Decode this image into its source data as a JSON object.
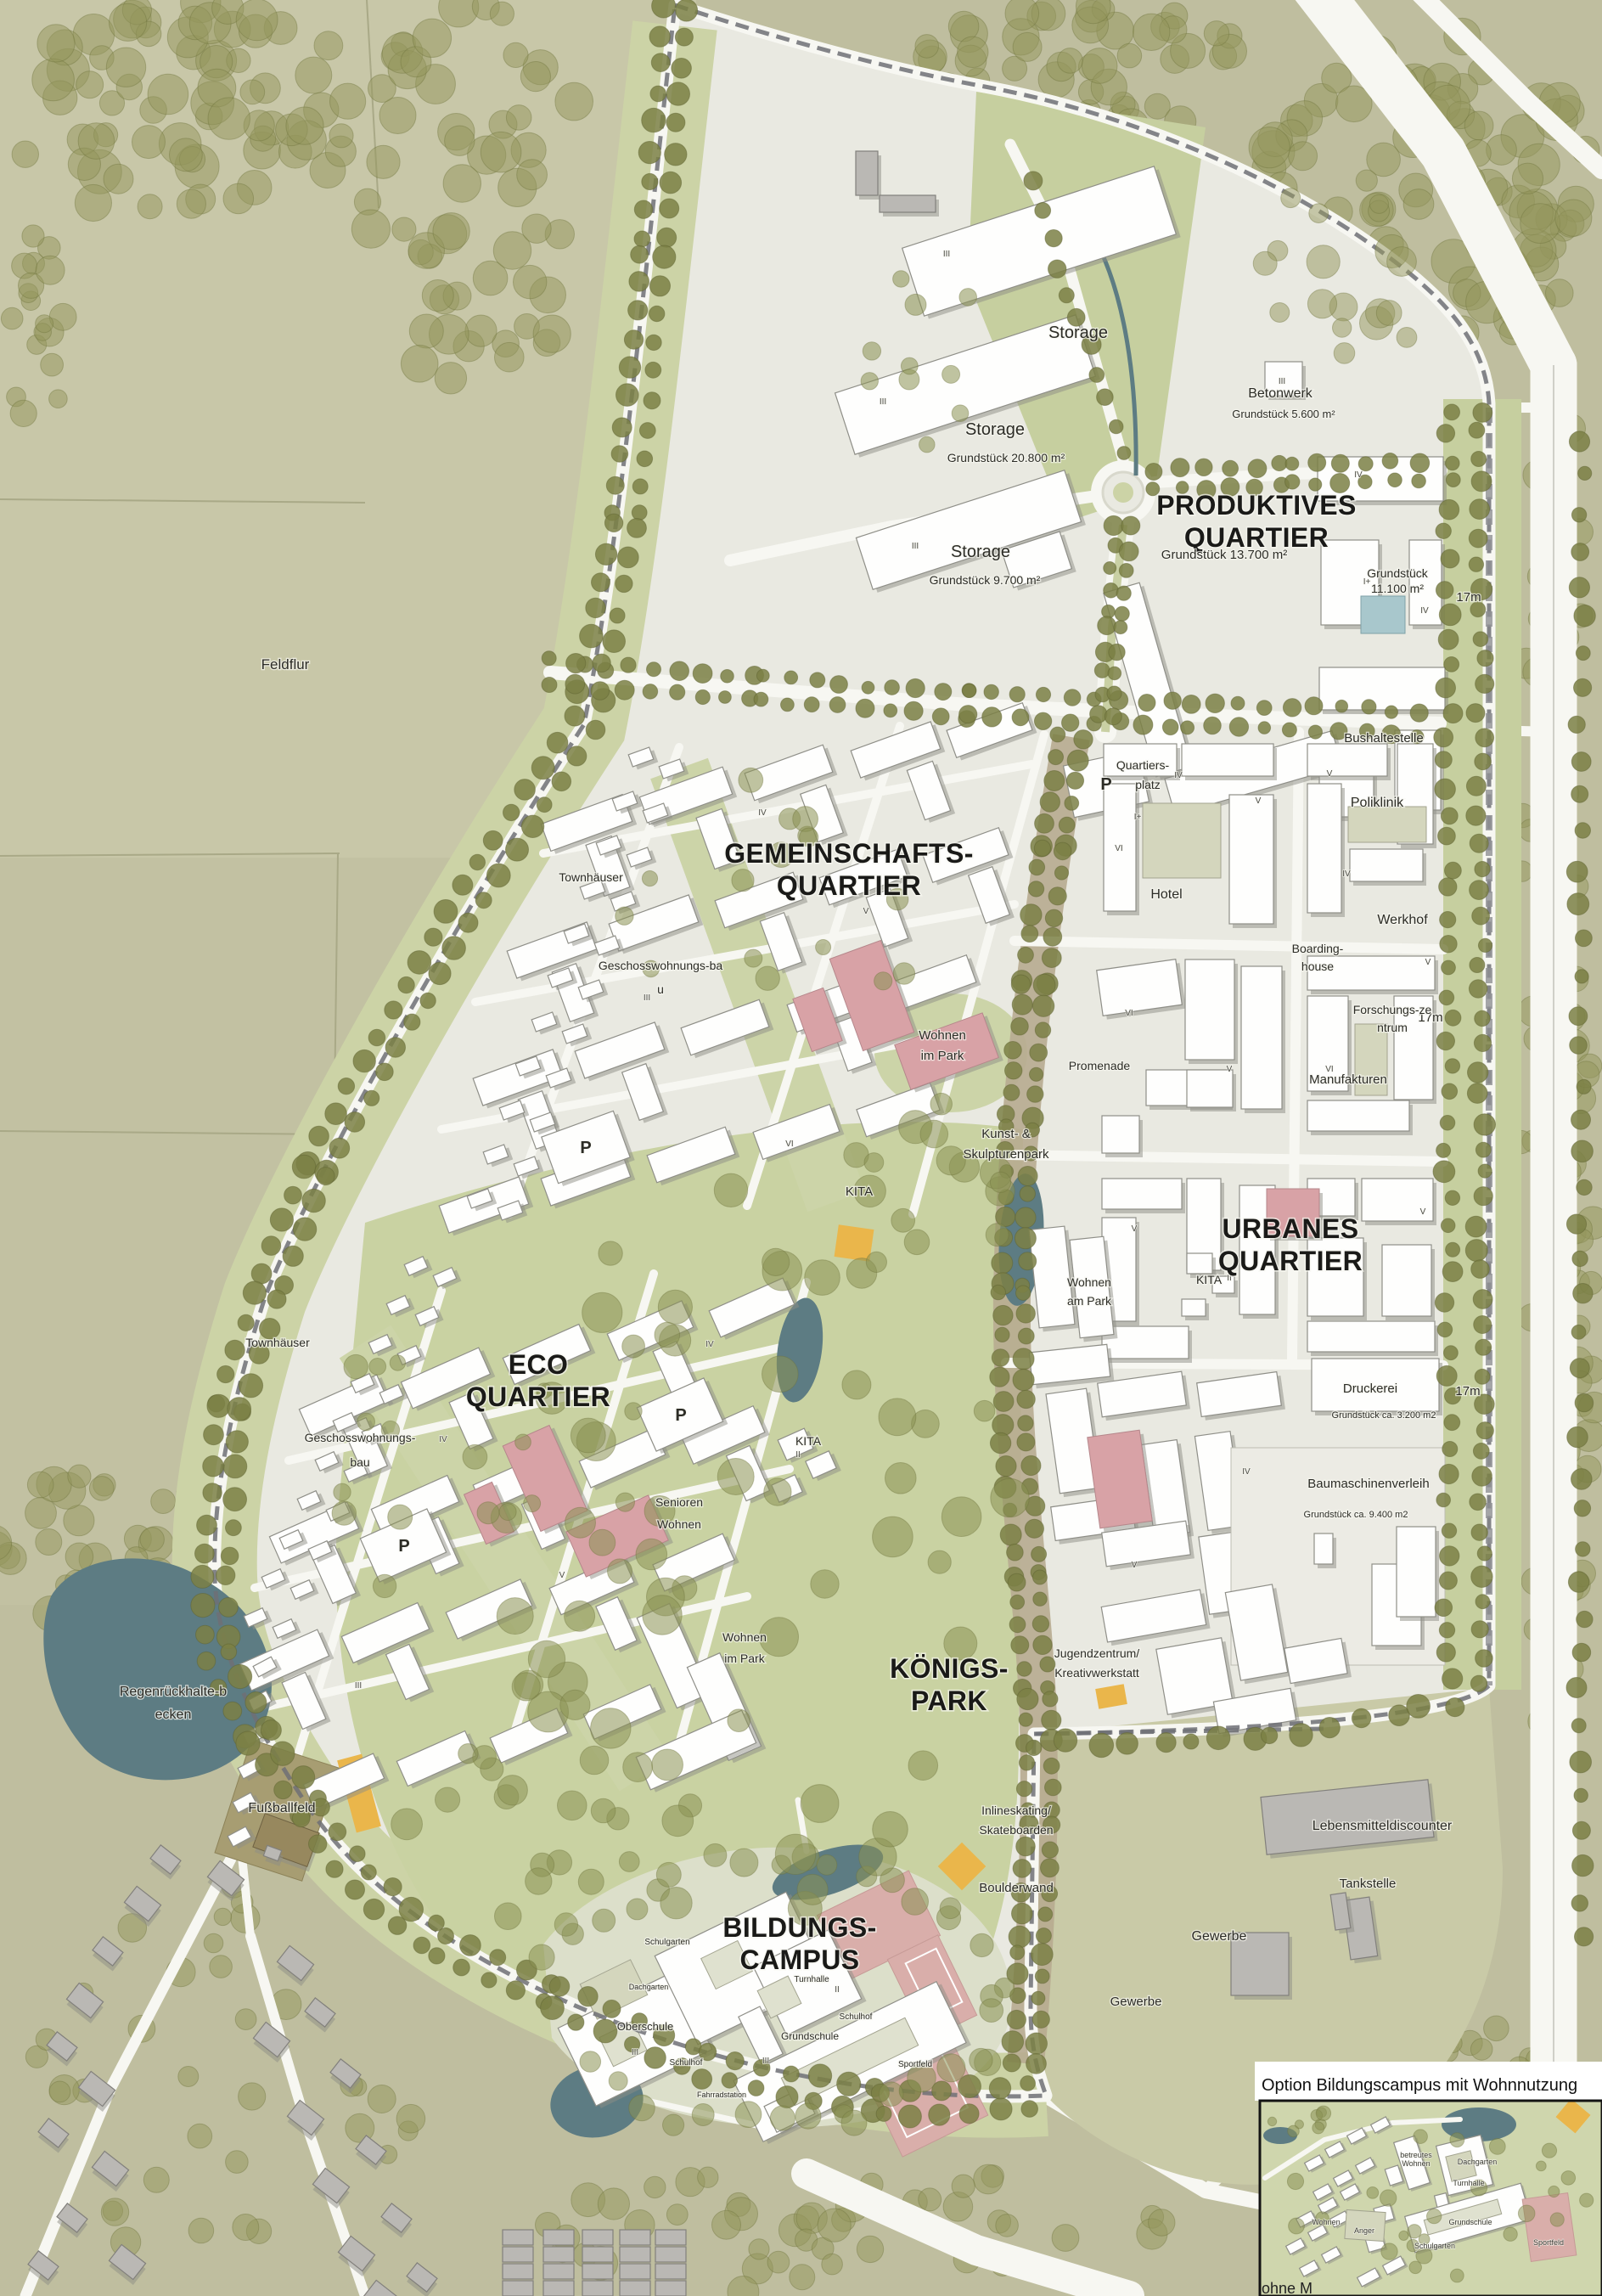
{
  "palette": {
    "field": "#bfbe9f",
    "field_light": "#c8c7a8",
    "forest_tree": "#94965c",
    "street_tree": "#7b8045",
    "site_ground": "#e9e9e1",
    "park_green": "#c9d2a2",
    "verge_green": "#ccd3a6",
    "belt_green": "#c6cf9f",
    "road_white": "#f7f7f2",
    "building_white": "#fefefd",
    "building_pink": "#d8a2a6",
    "existing_gray": "#bab8b4",
    "water_teal": "#5d7c83",
    "pool_blue": "#a8c7cc",
    "promenade_tan": "#b7ab90",
    "sport_pink": "#d9aeaa",
    "accent_orange": "#eab64b",
    "boundary_gray": "#6f7076",
    "label_ink": "#2c2c26"
  },
  "region_titles": {
    "produktives": "PRODUKTIVES",
    "gemeinschafts": "GEMEINSCHAFTS-",
    "urbanes": "URBANES",
    "eco": "ECO",
    "quartier": "QUARTIER",
    "koenigs": "KÖNIGS-",
    "park": "PARK",
    "bildungs": "BILDUNGS-",
    "campus": "CAMPUS"
  },
  "labels": {
    "feldflur": "Feldflur",
    "storage": "Storage",
    "g20800": "Grundstück 20.800 m²",
    "g9700": "Grundstück 9.700 m²",
    "betonwerk": "Betonwerk",
    "g5600": "Grundstück 5.600 m²",
    "g13700": "Grundstück 13.700 m²",
    "g11100a": "Grundstück",
    "g11100b": "11.100 m²",
    "bushaltestelle": "Bushaltestelle",
    "quartiersplatz_a": "Quartiers-",
    "quartiersplatz_b": "platz",
    "poliklinik": "Poliklinik",
    "townhaeuser": "Townhäuser",
    "hotel": "Hotel",
    "werkhof": "Werkhof",
    "boarding_a": "Boarding-",
    "boarding_b": "house",
    "geschoss_a": "Geschosswohnungs-ba",
    "geschoss_b": "u",
    "geschoss2_a": "Geschosswohnungs-",
    "geschoss2_b": "bau",
    "forschung_a": "Forschungs-ze",
    "forschung_b": "ntrum",
    "manufakturen": "Manufakturen",
    "promenade": "Promenade",
    "wohnen_im_park_a": "Wohnen",
    "wohnen_im_park_b": "im Park",
    "kunst_a": "Kunst- &",
    "kunst_b": "Skulpturenpark",
    "kita": "KITA",
    "wohnen_am_park_a": "Wohnen",
    "wohnen_am_park_b": "am Park",
    "senioren_a": "Senioren",
    "senioren_b": "Wohnen",
    "druckerei": "Druckerei",
    "g3200": "Grundstück ca. 3.200 m2",
    "baumaschinenverleih": "Baumaschinenverleih",
    "g9400": "Grundstück ca. 9.400 m2",
    "jugend_a": "Jugendzentrum/",
    "jugend_b": "Kreativwerkstatt",
    "regen_a": "Regenrückhalte-b",
    "regen_b": "ecken",
    "fussballfeld": "Fußballfeld",
    "inline_a": "Inlineskating/",
    "inline_b": "Skateboarden",
    "boulderwand": "Boulderwand",
    "lebensmitteldiscounter": "Lebensmitteldiscounter",
    "tankstelle": "Tankstelle",
    "gewerbe": "Gewerbe",
    "schulgarten": "Schulgarten",
    "dachgarten": "Dachgarten",
    "oberschule": "Oberschule",
    "schulhof": "Schulhof",
    "fahrradstation": "Fahrradstation",
    "turnhalle": "Turnhalle",
    "grundschule": "Grundschule",
    "sportfeld": "Sportfeld",
    "parking": "P",
    "width17": "17m",
    "anger": "Anger",
    "wohnen": "Wohnen",
    "betreut_a": "betreutes",
    "betreut_b": "Wohnen",
    "ohne": "ohne M"
  },
  "floors": {
    "i_plus": "I+",
    "ii": "II",
    "iii": "III",
    "iv": "IV",
    "v": "V",
    "vi": "VI"
  },
  "inset": {
    "title": "Option Bildungscampus mit Wohnnutzung"
  }
}
